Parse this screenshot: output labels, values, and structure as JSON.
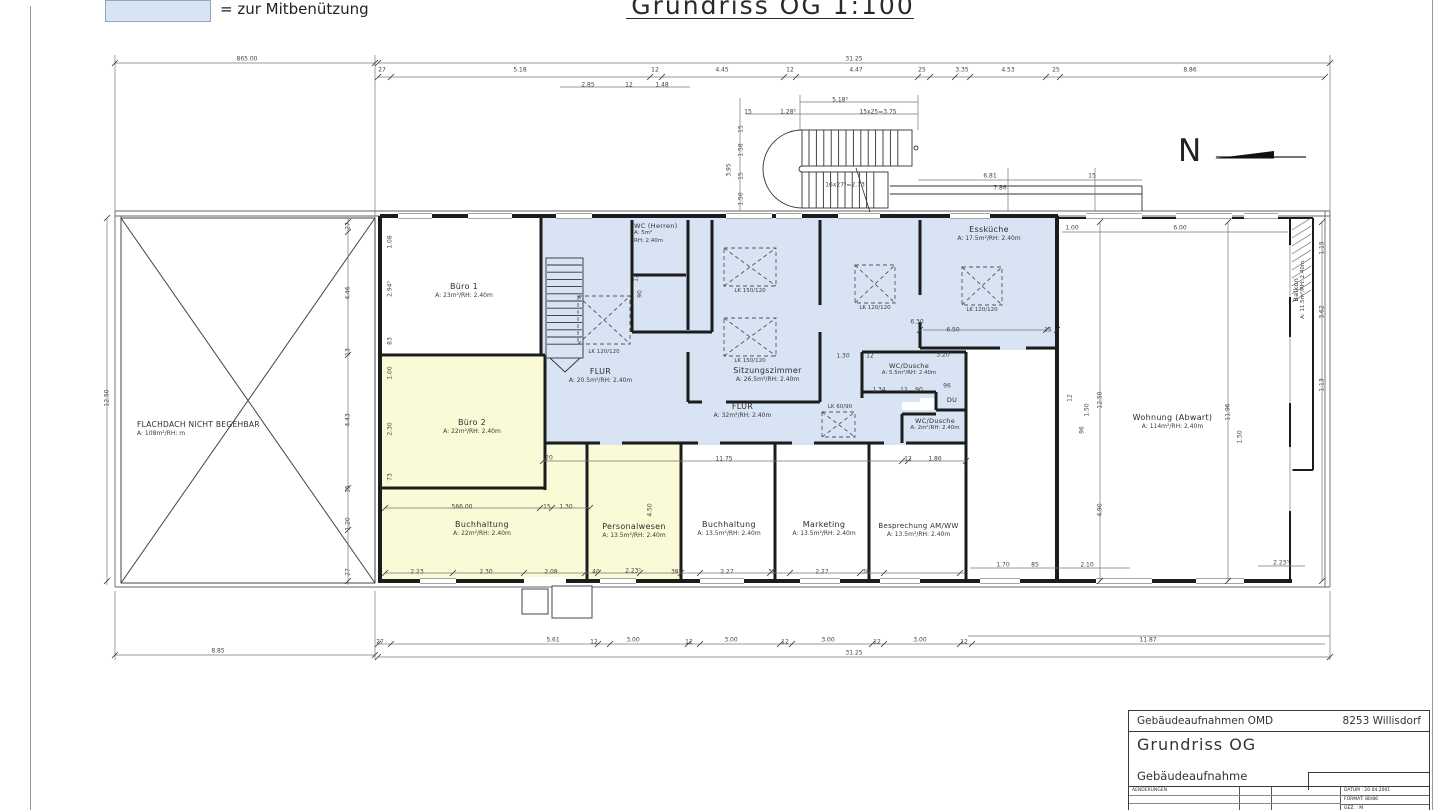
{
  "legend": {
    "label": "= zur Mitbenützung"
  },
  "title": "Grundriss OG 1:100",
  "north_label": "N",
  "colors": {
    "highlight_blue": "#d8e4f3",
    "highlight_yellow": "#fafad6",
    "wall": "#1c1c1c"
  },
  "plan": {
    "rooms": [
      {
        "name": "Büro 1",
        "info": "A: 23m²/RH: 2.40m"
      },
      {
        "name": "FLUR",
        "info": "A: 20.5m²/RH: 2.40m"
      },
      {
        "name": "WC (Herren)",
        "info": "A: 5m²",
        "info2": "RH: 2.40m"
      },
      {
        "name": "Sitzungszimmer",
        "info": "A: 26.5m²/RH: 2.40m"
      },
      {
        "name": "Essküche",
        "info": "A: 17.5m²/RH: 2.40m"
      },
      {
        "name": "WC/Dusche",
        "info": "A: 5.5m²/RH: 2.40m"
      },
      {
        "name": "DU"
      },
      {
        "name": "FLUR",
        "info": "A: 32m²/RH: 2.40m"
      },
      {
        "name": "WC/Dusche",
        "info": "A: 2m²/RH: 2.40m"
      },
      {
        "name": "Büro 2",
        "info": "A: 22m²/RH: 2.40m"
      },
      {
        "name": "Buchhaltung",
        "info": "A: 22m²/RH: 2.40m"
      },
      {
        "name": "Personalwesen",
        "info": "A: 13.5m²/RH: 2.40m"
      },
      {
        "name": "Buchhaltung",
        "info": "A: 13.5m²/RH: 2.40m"
      },
      {
        "name": "Marketing",
        "info": "A: 13.5m²/RH: 2.40m"
      },
      {
        "name": "Besprechung AM/WW",
        "info": "A: 13.5m²/RH: 2.40m"
      },
      {
        "name": "Wohnung (Abwart)",
        "info": "A: 114m²/RH: 2.40m"
      },
      {
        "name": "Balkon",
        "info": "A: 11.5m²/RH: 2.40m"
      },
      {
        "name": "FLACHDACH NICHT BEGEHBAR",
        "info": "A: 108m²/RH:  m"
      }
    ],
    "dimensions": [
      {
        "t": "865.00",
        "x": 247,
        "y": 59
      },
      {
        "t": "31.25",
        "x": 854,
        "y": 59
      },
      {
        "t": "27",
        "x": 382,
        "y": 70
      },
      {
        "t": "5.18",
        "x": 520,
        "y": 70
      },
      {
        "t": "12",
        "x": 655,
        "y": 70
      },
      {
        "t": "4.45",
        "x": 722,
        "y": 70
      },
      {
        "t": "12",
        "x": 790,
        "y": 70
      },
      {
        "t": "4.47",
        "x": 856,
        "y": 70
      },
      {
        "t": "25",
        "x": 922,
        "y": 70
      },
      {
        "t": "3.35",
        "x": 962,
        "y": 70
      },
      {
        "t": "4.53",
        "x": 1008,
        "y": 70
      },
      {
        "t": "25",
        "x": 1056,
        "y": 70
      },
      {
        "t": "8.86",
        "x": 1190,
        "y": 70
      },
      {
        "t": "2.85",
        "x": 588,
        "y": 85
      },
      {
        "t": "12",
        "x": 629,
        "y": 85
      },
      {
        "t": "1.48",
        "x": 662,
        "y": 85
      },
      {
        "t": "5.18⁵",
        "x": 840,
        "y": 100
      },
      {
        "t": "15",
        "x": 748,
        "y": 112
      },
      {
        "t": "1.28⁵",
        "x": 788,
        "y": 112
      },
      {
        "t": "15x25=3.75",
        "x": 878,
        "y": 112
      },
      {
        "t": "16x27⁵=2.73",
        "x": 845,
        "y": 185
      },
      {
        "t": "6.81",
        "x": 990,
        "y": 176
      },
      {
        "t": "7.86",
        "x": 1000,
        "y": 188
      },
      {
        "t": "15",
        "x": 1092,
        "y": 176
      },
      {
        "t": "15",
        "x": 741,
        "y": 129,
        "r": 1
      },
      {
        "t": "1.58",
        "x": 741,
        "y": 150,
        "r": 1
      },
      {
        "t": "3.95",
        "x": 729,
        "y": 170,
        "r": 1
      },
      {
        "t": "15",
        "x": 741,
        "y": 176,
        "r": 1
      },
      {
        "t": "1.50",
        "x": 741,
        "y": 199,
        "r": 1
      },
      {
        "t": "1.00",
        "x": 1072,
        "y": 228
      },
      {
        "t": "6.00",
        "x": 1180,
        "y": 228
      },
      {
        "t": "12.50",
        "x": 107,
        "y": 398,
        "r": 1
      },
      {
        "t": "8.85",
        "x": 218,
        "y": 651
      },
      {
        "t": "27",
        "x": 348,
        "y": 226,
        "r": 1
      },
      {
        "t": "4.46",
        "x": 348,
        "y": 293,
        "r": 1
      },
      {
        "t": "13",
        "x": 348,
        "y": 352,
        "r": 1
      },
      {
        "t": "4.43",
        "x": 348,
        "y": 420,
        "r": 1
      },
      {
        "t": "15",
        "x": 348,
        "y": 489,
        "r": 1
      },
      {
        "t": "1.20",
        "x": 348,
        "y": 524,
        "r": 1
      },
      {
        "t": "27",
        "x": 348,
        "y": 572,
        "r": 1
      },
      {
        "t": "1.08",
        "x": 390,
        "y": 242,
        "r": 1
      },
      {
        "t": "2.94⁵",
        "x": 390,
        "y": 289,
        "r": 1
      },
      {
        "t": "83",
        "x": 390,
        "y": 341,
        "r": 1
      },
      {
        "t": "1.00",
        "x": 390,
        "y": 373,
        "r": 1
      },
      {
        "t": "2.30",
        "x": 390,
        "y": 429,
        "r": 1
      },
      {
        "t": "73",
        "x": 390,
        "y": 477,
        "r": 1
      },
      {
        "t": "12",
        "x": 636,
        "y": 278,
        "r": 1
      },
      {
        "t": "90",
        "x": 640,
        "y": 294,
        "r": 1
      },
      {
        "t": "20",
        "x": 549,
        "y": 458
      },
      {
        "t": "566.00",
        "x": 462,
        "y": 507
      },
      {
        "t": "15",
        "x": 547,
        "y": 507
      },
      {
        "t": "1.30",
        "x": 566,
        "y": 507
      },
      {
        "t": "11.75",
        "x": 724,
        "y": 459
      },
      {
        "t": "12",
        "x": 908,
        "y": 459
      },
      {
        "t": "1.86",
        "x": 935,
        "y": 459
      },
      {
        "t": "4.50",
        "x": 650,
        "y": 510,
        "r": 1
      },
      {
        "t": "1.30",
        "x": 843,
        "y": 356
      },
      {
        "t": "12",
        "x": 870,
        "y": 356
      },
      {
        "t": "3.20",
        "x": 943,
        "y": 355
      },
      {
        "t": "6.30",
        "x": 917,
        "y": 322
      },
      {
        "t": "1.34",
        "x": 879,
        "y": 390
      },
      {
        "t": "12",
        "x": 904,
        "y": 390
      },
      {
        "t": "90",
        "x": 919,
        "y": 390
      },
      {
        "t": "96",
        "x": 947,
        "y": 386
      },
      {
        "t": "6.50",
        "x": 953,
        "y": 330
      },
      {
        "t": "15",
        "x": 1048,
        "y": 330
      },
      {
        "t": "2.23",
        "x": 417,
        "y": 572
      },
      {
        "t": "2.30",
        "x": 486,
        "y": 572
      },
      {
        "t": "2.08",
        "x": 551,
        "y": 572
      },
      {
        "t": "40",
        "x": 596,
        "y": 572
      },
      {
        "t": "2.23⁵",
        "x": 633,
        "y": 571
      },
      {
        "t": "38⁵",
        "x": 676,
        "y": 572
      },
      {
        "t": "2.27",
        "x": 727,
        "y": 572
      },
      {
        "t": "38",
        "x": 772,
        "y": 572
      },
      {
        "t": "2.27",
        "x": 822,
        "y": 572
      },
      {
        "t": "38",
        "x": 866,
        "y": 572
      },
      {
        "t": "1.70",
        "x": 1003,
        "y": 565
      },
      {
        "t": "85",
        "x": 1035,
        "y": 565
      },
      {
        "t": "2.10",
        "x": 1087,
        "y": 565
      },
      {
        "t": "2.23⁵",
        "x": 1281,
        "y": 563
      },
      {
        "t": "27",
        "x": 380,
        "y": 642
      },
      {
        "t": "5.61",
        "x": 553,
        "y": 640
      },
      {
        "t": "12",
        "x": 594,
        "y": 642
      },
      {
        "t": "3.00",
        "x": 633,
        "y": 640
      },
      {
        "t": "12",
        "x": 689,
        "y": 642
      },
      {
        "t": "3.00",
        "x": 731,
        "y": 640
      },
      {
        "t": "12",
        "x": 785,
        "y": 642
      },
      {
        "t": "3.00",
        "x": 828,
        "y": 640
      },
      {
        "t": "12",
        "x": 877,
        "y": 642
      },
      {
        "t": "3.00",
        "x": 920,
        "y": 640
      },
      {
        "t": "12",
        "x": 964,
        "y": 642
      },
      {
        "t": "31.25",
        "x": 854,
        "y": 653
      },
      {
        "t": "11.87",
        "x": 1148,
        "y": 640
      },
      {
        "t": "12.50",
        "x": 1100,
        "y": 400,
        "r": 1
      },
      {
        "t": "11.96",
        "x": 1228,
        "y": 412,
        "r": 1
      },
      {
        "t": "1.50",
        "x": 1240,
        "y": 437,
        "r": 1
      },
      {
        "t": "96",
        "x": 1082,
        "y": 430,
        "r": 1
      },
      {
        "t": "1.50",
        "x": 1087,
        "y": 410,
        "r": 1
      },
      {
        "t": "12",
        "x": 1070,
        "y": 398,
        "r": 1
      },
      {
        "t": "4.90",
        "x": 1100,
        "y": 510,
        "r": 1
      },
      {
        "t": "1.15",
        "x": 1322,
        "y": 248,
        "r": 1
      },
      {
        "t": "3.62",
        "x": 1322,
        "y": 312,
        "r": 1
      },
      {
        "t": "1.13",
        "x": 1322,
        "y": 385,
        "r": 1
      }
    ],
    "skylights": [
      {
        "t": "LK 120/120",
        "x": 604,
        "y": 352
      },
      {
        "t": "LK 150/120",
        "x": 750,
        "y": 291
      },
      {
        "t": "LK 150/120",
        "x": 750,
        "y": 361
      },
      {
        "t": "LK 120/120",
        "x": 875,
        "y": 308
      },
      {
        "t": "LK 120/120",
        "x": 982,
        "y": 310
      },
      {
        "t": "LK 60/90",
        "x": 840,
        "y": 407
      }
    ]
  },
  "title_block": {
    "company": "Gebäudeaufnahmen OMD",
    "location": "8253 Willisdorf",
    "drawing": "Grundriss OG",
    "subtitle": "Gebäudeaufnahme",
    "changes_label": "AENDERUNGEN",
    "datum": "DATUM : 20.04.2001",
    "format": "FORMAT: 80/86",
    "gez": "GEZ. : M"
  }
}
